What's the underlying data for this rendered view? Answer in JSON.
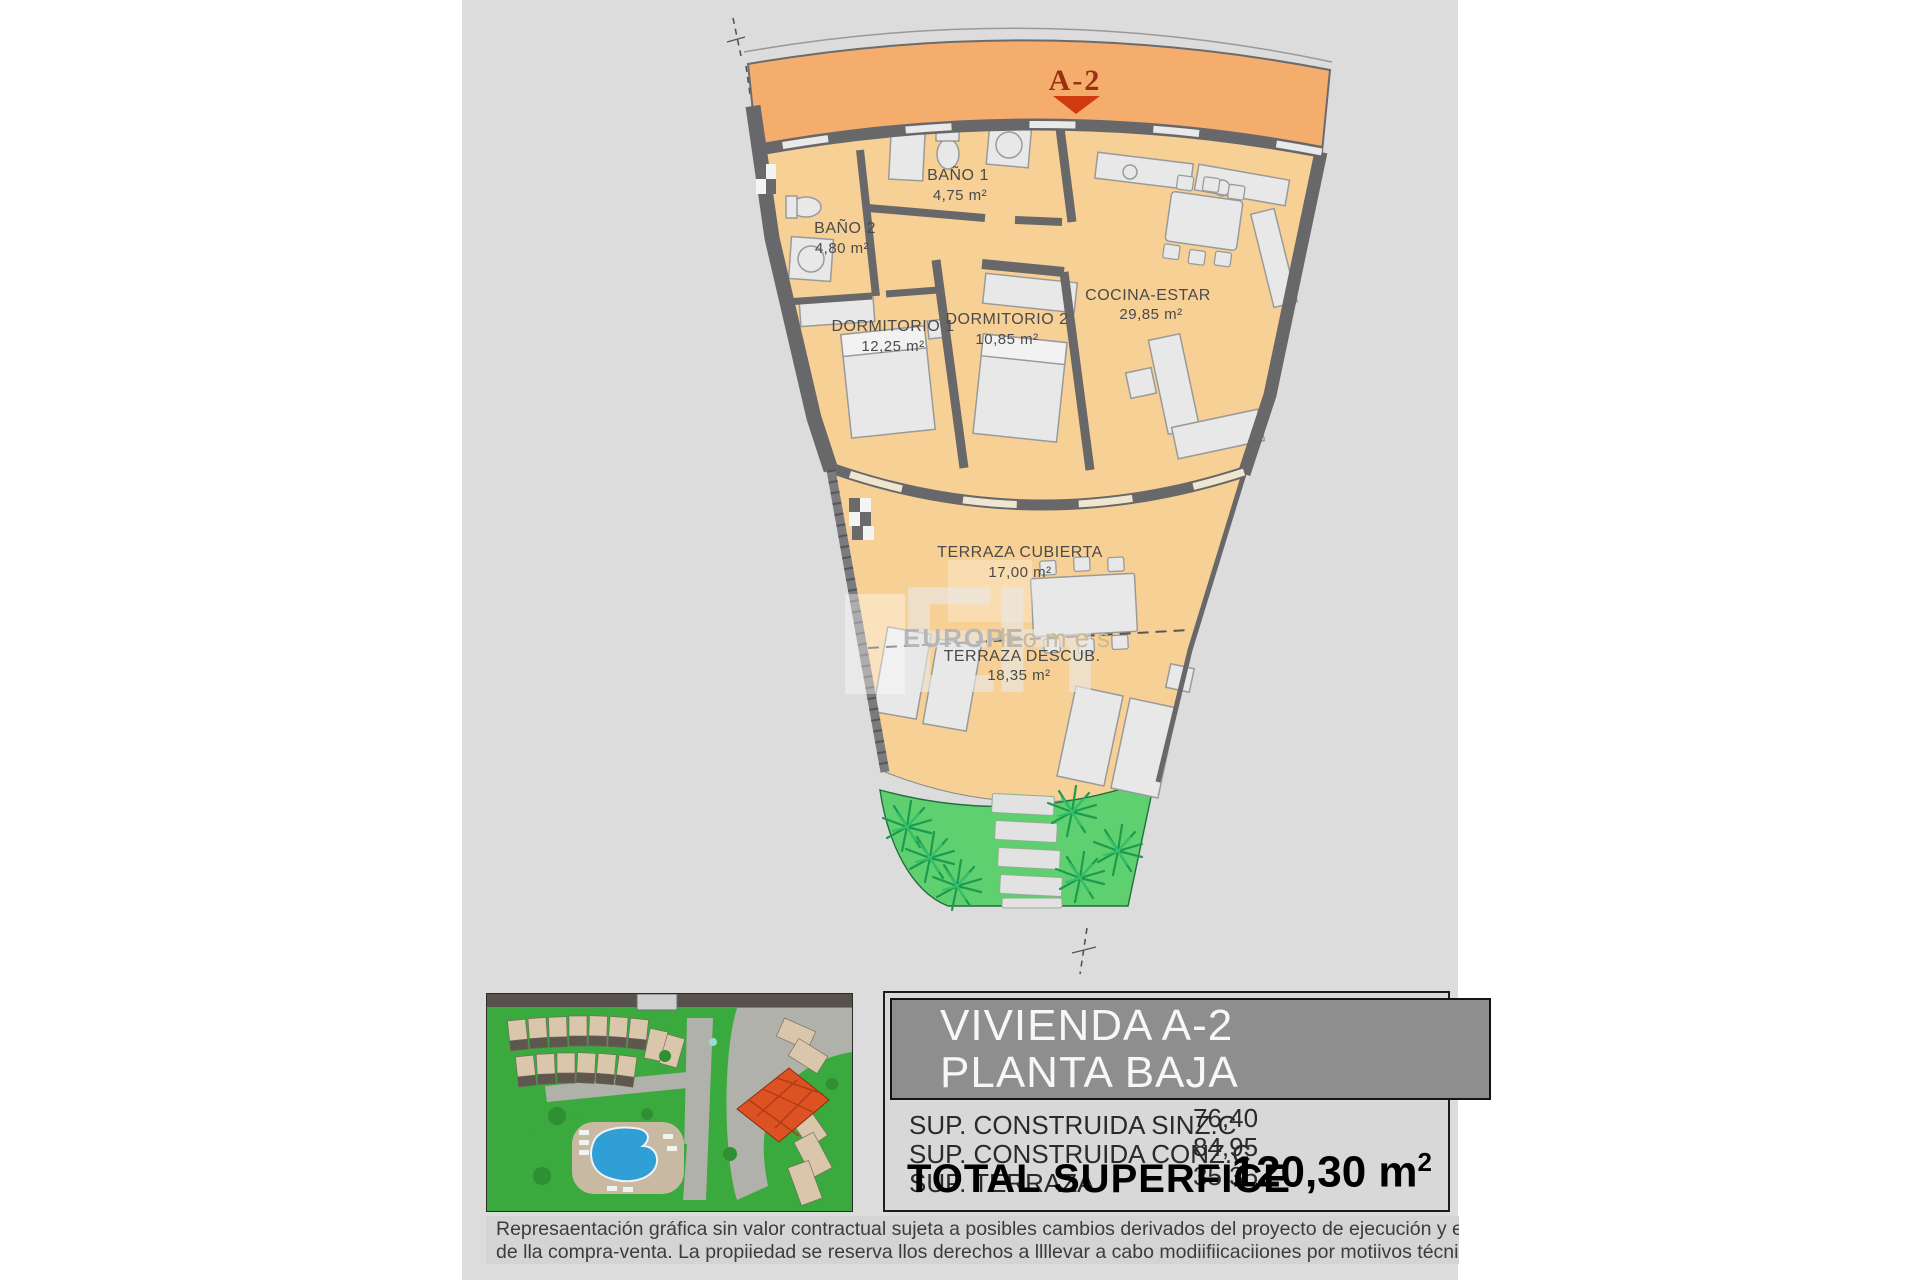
{
  "plan": {
    "unit_label": "A-2",
    "rooms": [
      {
        "name": "BAÑO 1",
        "area": "4,75 m²"
      },
      {
        "name": "BAÑO 2",
        "area": "4,80 m²"
      },
      {
        "name": "DORMITORIO 1",
        "area": "12,25 m²"
      },
      {
        "name": "DORMITORIO 2",
        "area": "10,85 m²"
      },
      {
        "name": "COCINA-ESTAR",
        "area": "29,85 m²"
      },
      {
        "name": "TERRAZA CUBIERTA",
        "area": "17,00 m²"
      },
      {
        "name": "TERRAZA DESCUB.",
        "area": "18,35 m²"
      }
    ],
    "watermark": {
      "initials": "EH",
      "brand": "EUROPE",
      "brand2": "homes"
    },
    "colors": {
      "corridor_orange": "#f5ad6e",
      "floor_tan": "#f7d096",
      "wall_gray": "#68686a",
      "garden_green": "#5fd06f",
      "marker_red": "#cf3a0f",
      "marker_text": "#9b3110"
    }
  },
  "info_panel": {
    "title_line1": "VIVIENDA A-2",
    "title_line2": "PLANTA BAJA",
    "rows": [
      {
        "label": "SUP. CONSTRUIDA SINZ.C",
        "value": "76,40"
      },
      {
        "label": "SUP. CONSTRUIDA CONZ.C",
        "value": "84,95"
      },
      {
        "label": "SUP. TERRAZA",
        "value": "35,35"
      }
    ],
    "total_label": "TOTAL SUPERFICE",
    "total_value": "120,30 m",
    "total_superscript": "2"
  },
  "disclaimer": {
    "line1": "Represaentación gráfica sin valor contractual sujeta a posibles cambios derivados del proyecto de ejecución y en cualquier caso será sustituido por el definitivo er",
    "line2": "de lla compra-venta. La propiiedad se reserva llos derechos a llllevar a cabo modiifiicaciiones por motiivos técniicos y cumplliiendo lla normatiiva viigente."
  }
}
